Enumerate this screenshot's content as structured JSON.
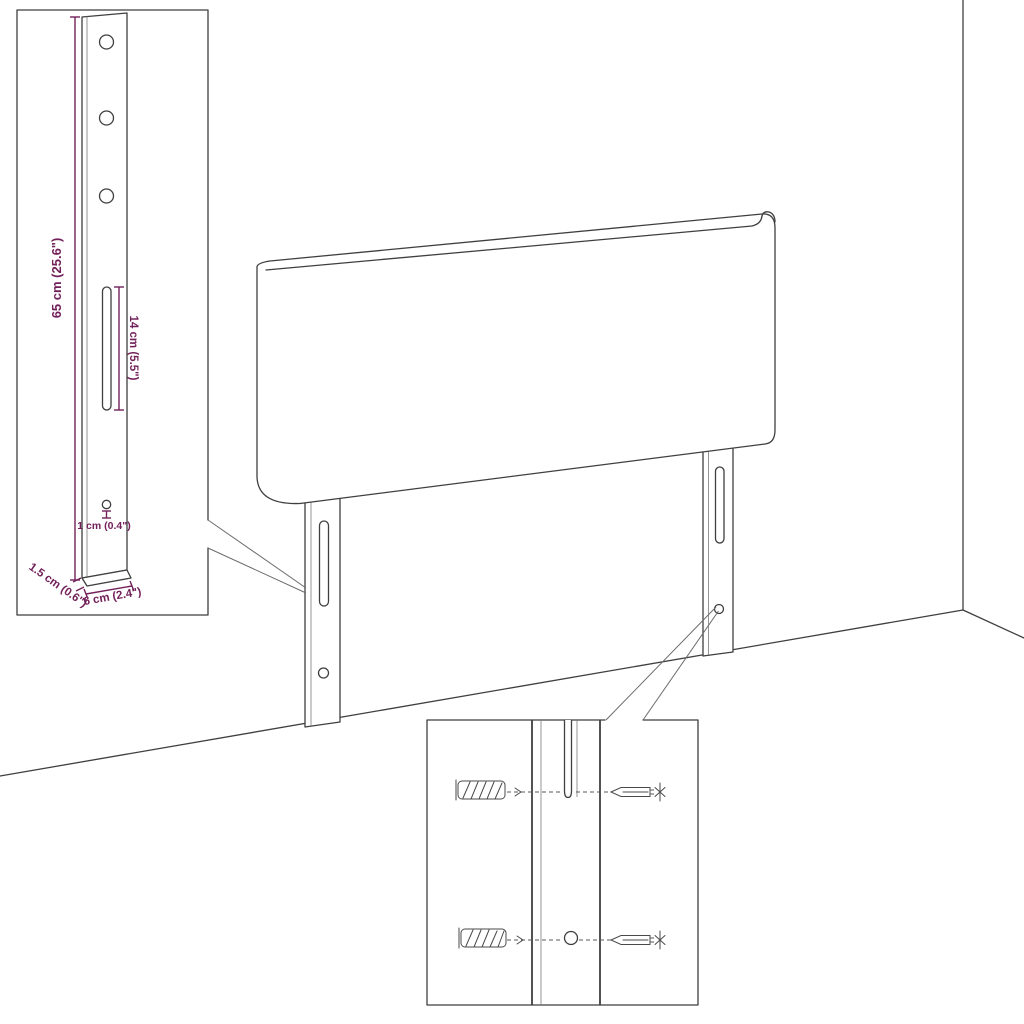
{
  "diagram": {
    "type": "furniture-dimension-diagram",
    "subject": "Upholstered headboard with two mounting legs shown against a room wall corner, with a leg dimension inset and a wall-fixing hardware inset",
    "colors": {
      "background": "#ffffff",
      "outline": "#3f3f3f",
      "dimension": "#72215a"
    },
    "leg_detail": {
      "height_label": "65 cm (25.6\")",
      "slot_label": "14 cm (5.5\")",
      "hole_label": "1 cm (0.4\")",
      "thickness_label": "1.5 cm (0.6\")",
      "width_label": "6 cm (2.4\")"
    },
    "mounting_detail": {
      "parts": [
        "wall plug",
        "screw",
        "keyhole slot",
        "screw hole"
      ]
    }
  }
}
